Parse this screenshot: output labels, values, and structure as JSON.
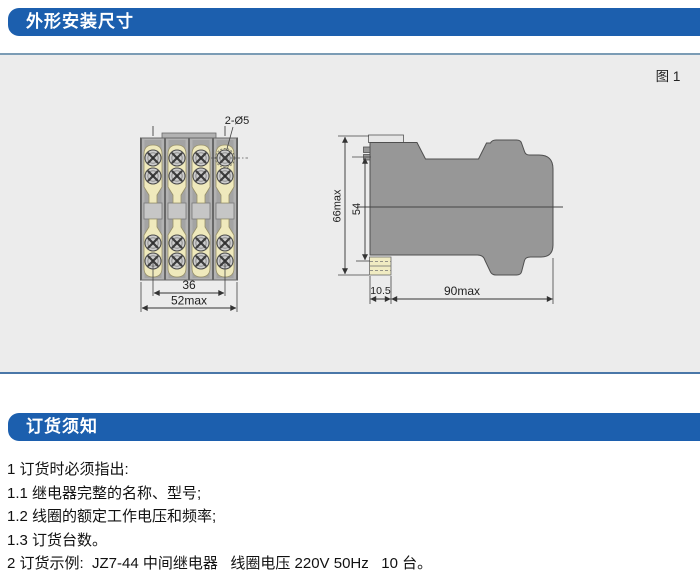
{
  "page": {
    "section1_title": "外形安装尺寸",
    "section2_title": "订货须知",
    "figure_label": "图 1"
  },
  "drawing": {
    "front_view": {
      "hole_label": "2-Ø5",
      "dim_inner_width": "36",
      "dim_outer_width": "52max"
    },
    "side_view": {
      "dim_height_outer": "66max",
      "dim_height_inner": "54",
      "dim_terminal_depth": "10.5",
      "dim_depth": "90max"
    }
  },
  "notes": {
    "lines": [
      "1 订货时必须指出:",
      "1.1 继电器完整的名称、型号;",
      "1.2 线圈的额定工作电压和频率;",
      "1.3 订货台数。",
      "2 订货示例:  JZ7-44 中间继电器   线圈电压 220V 50Hz   10 台。"
    ]
  },
  "colors": {
    "accent_blue": "#1c5fae",
    "panel_background": "#ececec",
    "body_gray": "#979797",
    "terminal_cream": "#efe9bc"
  }
}
